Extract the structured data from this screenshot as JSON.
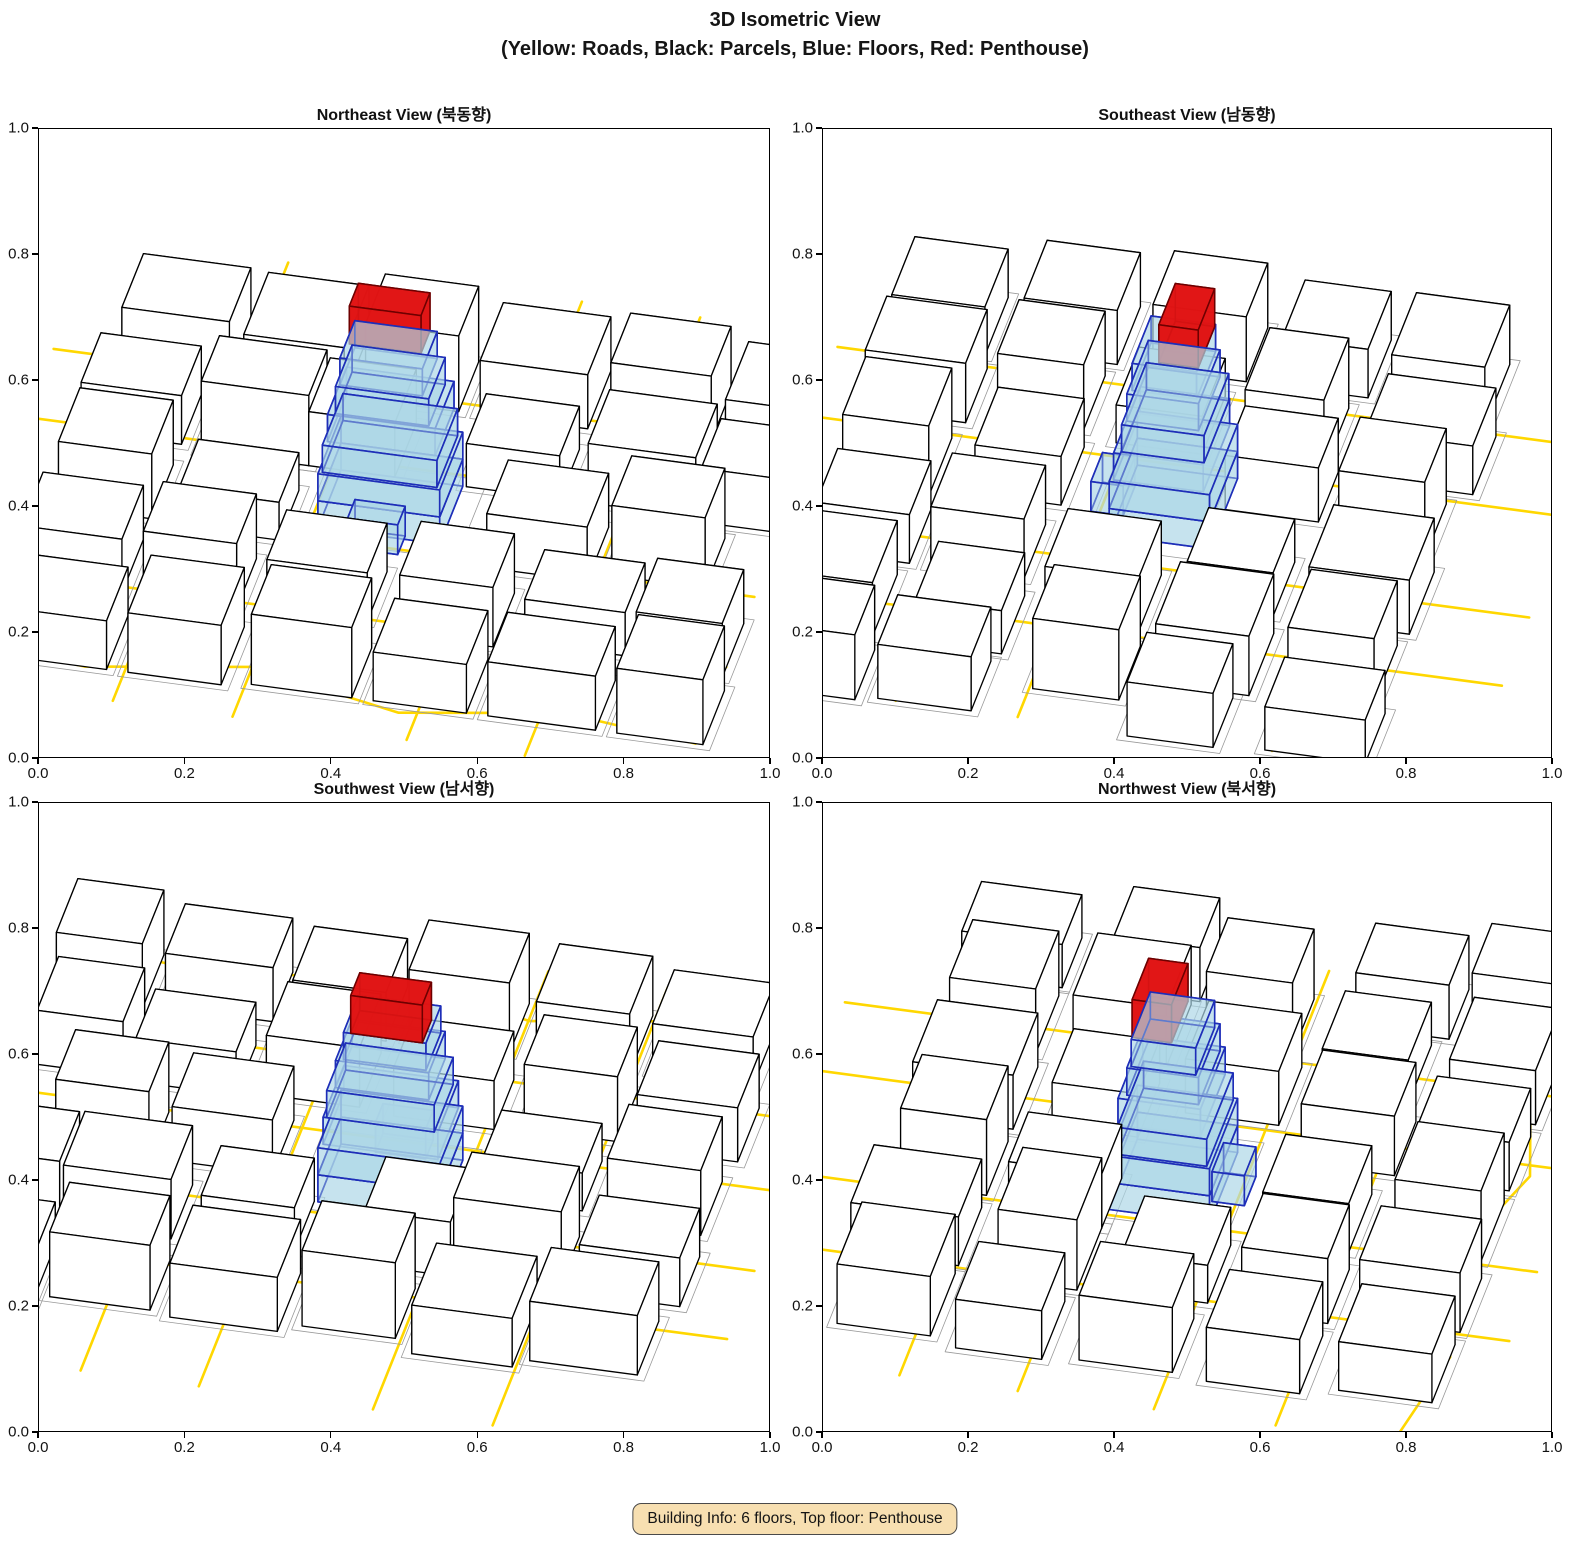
{
  "header": {
    "title_line1": "3D Isometric View",
    "title_line2": "(Yellow: Roads, Black: Parcels, Blue: Floors, Red: Penthouse)"
  },
  "views": [
    {
      "title": "Northeast View (북동향)",
      "azimuth_deg": -32
    },
    {
      "title": "Southeast View (남동향)",
      "azimuth_deg": 58
    },
    {
      "title": "Southwest View (남서향)",
      "azimuth_deg": 148
    },
    {
      "title": "Northwest View (북서향)",
      "azimuth_deg": 238
    }
  ],
  "axes": {
    "x_ticks": [
      "0.0",
      "0.2",
      "0.4",
      "0.6",
      "0.8",
      "1.0"
    ],
    "y_ticks": [
      "0.0",
      "0.2",
      "0.4",
      "0.6",
      "0.8",
      "1.0"
    ],
    "x_range": [
      0.0,
      1.0
    ],
    "y_range": [
      0.0,
      1.0
    ]
  },
  "colors": {
    "road": "#FFD700",
    "parcel_edge": "#000000",
    "parcel_fill": "#ffffff",
    "ground_line": "#9a9a9a",
    "floor_fill": "#ADD8E6",
    "floor_fill_opacity": 0.45,
    "floor_edge": "#1E2EB8",
    "penthouse_fill": "#E01414",
    "penthouse_fill_opacity": 0.9,
    "penthouse_edge": "#6E0000",
    "badge_bg": "#F7DFB1",
    "badge_border": "#4a4a4a"
  },
  "chart_data": {
    "type": "scatter",
    "title": "3D Isometric View (Yellow: Roads, Black: Parcels, Blue: Floors, Red: Penthouse)",
    "subplots": [
      "Northeast View (북동향)",
      "Southeast View (남동향)",
      "Southwest View (남서향)",
      "Northwest View (북서향)"
    ],
    "xlabel": "",
    "ylabel": "",
    "xlim": [
      0.0,
      1.0
    ],
    "ylim": [
      0.0,
      1.0
    ],
    "grid": false,
    "legend_position": "none",
    "notes": "Each subplot shows the same 3D block scene from a different azimuth: white extruded parcels with black edges, gold road centerlines, a translucent blue 6-floor tower with small annex, and a red penthouse box on top, centered near (0.5, 0.45) in axes coordinates."
  },
  "scene": {
    "buildings": [
      [
        -4.3,
        -3.7,
        1.5,
        1.3,
        1.1
      ],
      [
        -2.6,
        -3.9,
        1.4,
        1.5,
        0.9
      ],
      [
        -0.9,
        -3.6,
        1.3,
        1.2,
        1.4
      ],
      [
        0.7,
        -3.8,
        1.5,
        1.4,
        1.0
      ],
      [
        2.5,
        -3.7,
        1.4,
        1.2,
        1.2
      ],
      [
        4.1,
        -3.9,
        1.2,
        1.4,
        0.8
      ],
      [
        -4.5,
        -2.0,
        1.4,
        1.2,
        0.9
      ],
      [
        -2.8,
        -1.8,
        1.5,
        1.1,
        1.3
      ],
      [
        -1.3,
        -2.0,
        1.2,
        1.3,
        1.0
      ],
      [
        0.9,
        -1.9,
        1.3,
        1.2,
        0.8
      ],
      [
        2.6,
        -2.0,
        1.5,
        1.3,
        1.1
      ],
      [
        4.2,
        -1.8,
        1.2,
        1.2,
        1.0
      ],
      [
        -4.4,
        -0.3,
        1.3,
        1.3,
        1.2
      ],
      [
        -2.7,
        -0.1,
        1.4,
        1.2,
        0.7
      ],
      [
        1.6,
        -0.2,
        1.4,
        1.3,
        1.0
      ],
      [
        3.3,
        -0.3,
        1.3,
        1.2,
        1.3
      ],
      [
        -4.5,
        1.5,
        1.4,
        1.3,
        1.0
      ],
      [
        -2.8,
        1.6,
        1.3,
        1.2,
        1.2
      ],
      [
        -1.1,
        1.5,
        1.4,
        1.2,
        0.9
      ],
      [
        0.8,
        1.6,
        1.3,
        1.3,
        1.1
      ],
      [
        2.5,
        1.5,
        1.4,
        1.2,
        0.8
      ],
      [
        4.1,
        1.6,
        1.2,
        1.3,
        1.0
      ],
      [
        -4.3,
        3.3,
        1.4,
        1.3,
        0.9
      ],
      [
        -2.6,
        3.2,
        1.3,
        1.4,
        1.1
      ],
      [
        -0.9,
        3.3,
        1.4,
        1.2,
        1.3
      ],
      [
        0.8,
        3.2,
        1.3,
        1.3,
        0.9
      ],
      [
        2.4,
        3.3,
        1.5,
        1.2,
        1.0
      ],
      [
        4.2,
        3.2,
        1.2,
        1.3,
        1.2
      ]
    ],
    "roads": [
      [
        [
          -5.3,
          -2.6
        ],
        [
          5.3,
          -2.6
        ]
      ],
      [
        [
          -5.3,
          -0.95
        ],
        [
          5.3,
          -0.95
        ]
      ],
      [
        [
          -5.3,
          0.95
        ],
        [
          5.3,
          0.95
        ]
      ],
      [
        [
          -5.3,
          2.65
        ],
        [
          5.3,
          2.65
        ]
      ],
      [
        [
          -2.65,
          -5.3
        ],
        [
          -2.65,
          5.3
        ]
      ],
      [
        [
          -0.98,
          -5.3
        ],
        [
          -0.98,
          5.3
        ]
      ],
      [
        [
          1.45,
          -5.3
        ],
        [
          1.45,
          5.3
        ]
      ],
      [
        [
          3.1,
          -5.3
        ],
        [
          3.1,
          5.3
        ]
      ],
      [
        [
          -5.3,
          4.3
        ],
        [
          -3.2,
          4.6
        ],
        [
          -1.0,
          4.1
        ],
        [
          1.2,
          4.7
        ],
        [
          3.4,
          4.2
        ],
        [
          5.3,
          4.5
        ]
      ]
    ],
    "parcels": [
      [
        -1.05,
        -0.9,
        2.2,
        1.9
      ]
    ],
    "tower": {
      "floors": [
        [
          -0.85,
          -0.7,
          1.7,
          1.4,
          0.5
        ],
        [
          -0.85,
          -0.7,
          1.7,
          1.4,
          0.5
        ],
        [
          -0.8,
          -0.6,
          1.6,
          1.25,
          0.5
        ],
        [
          -0.75,
          -0.6,
          1.5,
          1.15,
          0.5
        ],
        [
          -0.65,
          -0.5,
          1.3,
          1.0,
          0.5
        ],
        [
          -0.6,
          -0.45,
          1.15,
          0.9,
          0.5
        ]
      ],
      "annex": [
        -0.35,
        0.62,
        0.7,
        0.45,
        0.55
      ],
      "penthouse": [
        -0.55,
        -0.45,
        1.0,
        0.55,
        0.7
      ],
      "floor_count": 6
    }
  },
  "footer": {
    "badge": "Building Info: 6 floors, Top floor: Penthouse"
  }
}
